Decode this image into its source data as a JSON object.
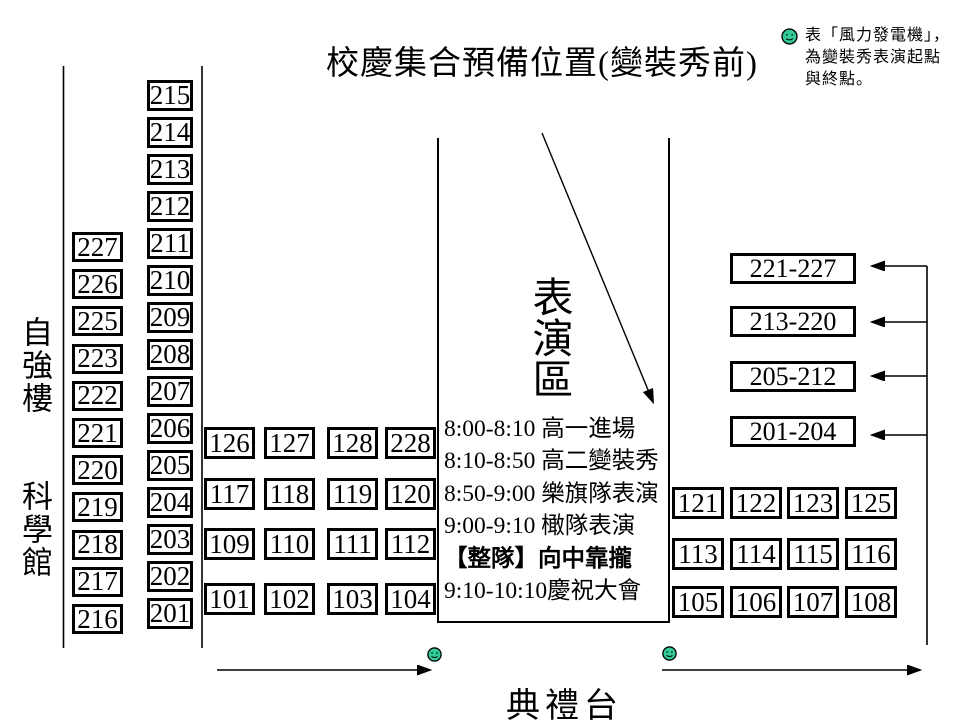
{
  "title": "校慶集合預備位置(變裝秀前)",
  "legend": {
    "icon": "wind-turbine-smiley",
    "lines": [
      "表「風力發電機」，",
      "為變裝秀表演起點",
      "與終點。"
    ]
  },
  "buildings": {
    "top": "自強樓",
    "bottom": "科學館"
  },
  "performance_area": {
    "label": "表演區",
    "schedule": [
      {
        "text": "8:00-8:10 高一進場",
        "bold": false
      },
      {
        "text": "8:10-8:50 高二變裝秀",
        "bold": false
      },
      {
        "text": "8:50-9:00 樂旗隊表演",
        "bold": false
      },
      {
        "text": "9:00-9:10 橄隊表演",
        "bold": false
      },
      {
        "text": "【整隊】向中靠攏",
        "bold": true
      },
      {
        "text": "9:10-10:10慶祝大會",
        "bold": false
      }
    ]
  },
  "stage_label": "典禮台",
  "seat_columns": {
    "left": [
      "227",
      "226",
      "225",
      "223",
      "222",
      "221",
      "220",
      "219",
      "218",
      "217",
      "216"
    ],
    "right": [
      "215",
      "214",
      "213",
      "212",
      "211",
      "210",
      "209",
      "208",
      "207",
      "206",
      "205",
      "204",
      "203",
      "202",
      "201"
    ]
  },
  "mid_block": [
    [
      "126",
      "127",
      "128",
      "228"
    ],
    [
      "117",
      "118",
      "119",
      "120"
    ],
    [
      "109",
      "110",
      "111",
      "112"
    ],
    [
      "101",
      "102",
      "103",
      "104"
    ]
  ],
  "group_boxes": [
    "221-227",
    "213-220",
    "205-212",
    "201-204"
  ],
  "right_block": [
    [
      "121",
      "122",
      "123",
      "125"
    ],
    [
      "113",
      "114",
      "115",
      "116"
    ],
    [
      "105",
      "106",
      "107",
      "108"
    ]
  ],
  "colors": {
    "smiley_fill": "#33CC99",
    "line": "#000000",
    "background": "#FFFFFF"
  }
}
